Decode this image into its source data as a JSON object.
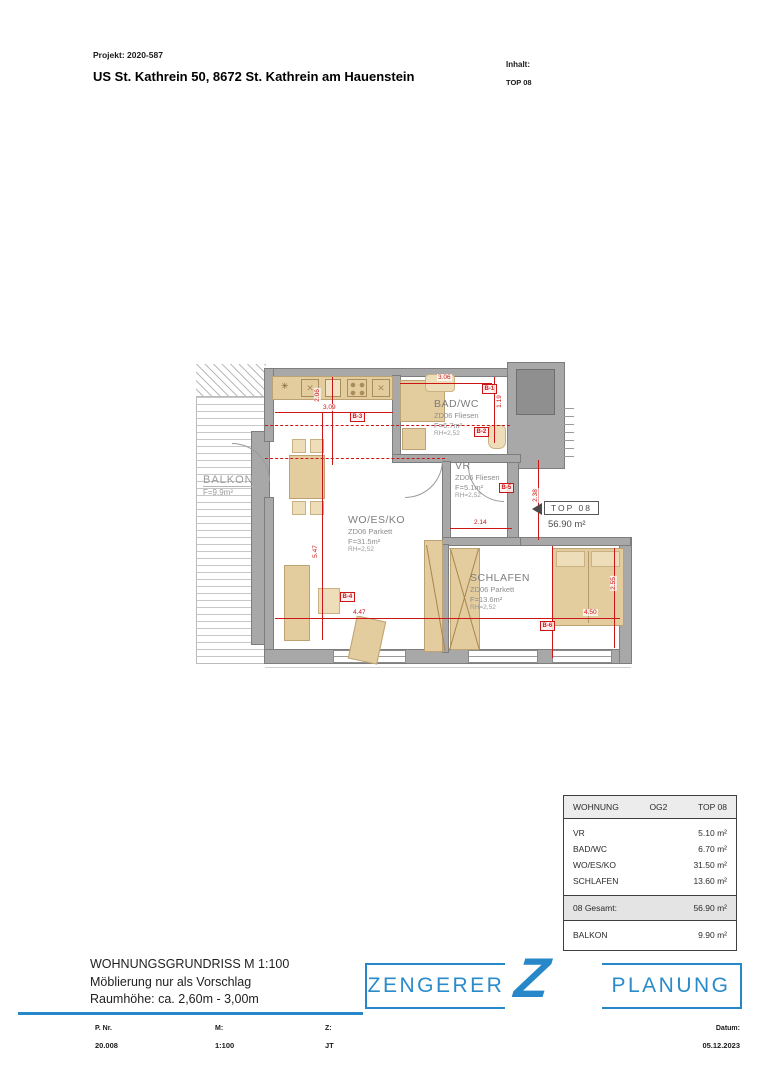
{
  "header": {
    "project_label": "Projekt: 2020-587",
    "title": "US St. Kathrein 50, 8672 St. Kathrein am Hauenstein",
    "content_label": "Inhalt:",
    "content_value": "TOP 08"
  },
  "icons": {
    "kitchen_symbol": "✳",
    "cross": "✕"
  },
  "plan": {
    "rooms": [
      {
        "name": "BALKON",
        "area": "F=9.9m²"
      },
      {
        "name": "BAD/WC",
        "floor": "ZD06 Fliesen",
        "area": "F=6.7m²",
        "height": "RH=2,52"
      },
      {
        "name": "VR",
        "floor": "ZD06 Fliesen",
        "area": "F=5.1m²",
        "height": "RH=2,52"
      },
      {
        "name": "WO/ES/KO",
        "floor": "ZD06 Parkett",
        "area": "F=31.5m²",
        "height": "RH=2,52"
      },
      {
        "name": "SCHLAFEN",
        "floor": "ZD06 Parkett",
        "area": "F=13.6m²",
        "height": "RH=2,52"
      }
    ],
    "top_flag": {
      "label": "TOP 08",
      "area": "56.90 m²"
    },
    "dims": [
      "3.09",
      "2.06",
      "3.06",
      "1.19",
      "2.14",
      "2.38",
      "5.47",
      "4.47",
      "4.50",
      "2.55"
    ],
    "markers": [
      "B-1",
      "B-2",
      "B-3",
      "B-4",
      "B-5",
      "B-6"
    ]
  },
  "table": {
    "header": {
      "col1": "WOHNUNG",
      "col2": "OG2",
      "col3": "TOP 08"
    },
    "rows": [
      [
        "VR",
        "5.10 m²"
      ],
      [
        "BAD/WC",
        "6.70 m²"
      ],
      [
        "WO/ES/KO",
        "31.50 m²"
      ],
      [
        "SCHLAFEN",
        "13.60 m²"
      ]
    ],
    "total": {
      "label": "08 Gesamt:",
      "value": "56.90 m²"
    },
    "balkon": {
      "label": "BALKON",
      "value": "9.90 m²"
    }
  },
  "titleblock": {
    "line1": "WOHNUNGSGRUNDRISS M 1:100",
    "line2": "Möblierung nur als Vorschlag",
    "line3": "Raumhöhe: ca. 2,60m - 3,00m"
  },
  "logo": {
    "left": "ZENGERER",
    "z": "Z",
    "right": "PLANUNG",
    "color": "#2688c8"
  },
  "footer": {
    "pnr_label": "P. Nr.",
    "pnr_value": "20.008",
    "m_label": "M:",
    "m_value": "1:100",
    "z_label": "Z:",
    "z_value": "JT",
    "datum_label": "Datum:",
    "datum_value": "05.12.2023"
  }
}
